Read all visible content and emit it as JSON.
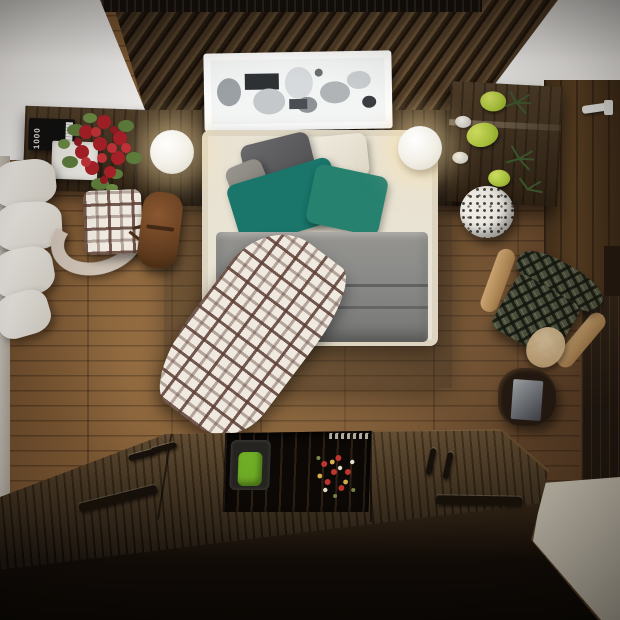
{
  "scene": {
    "description": "Top-down 3D render of a modern bedroom with dark wood accents",
    "book": {
      "spine_label": "1000"
    },
    "palette": {
      "floor_wood": "#7b5733",
      "ceiling_slats": "#473520",
      "white_ceiling": "#f4f3f1",
      "walnut_furniture": "#3c2c1a",
      "platform_deck": "#4a3723",
      "platform_front": "#0a0705",
      "bed_upholstery": "#e9e3d3",
      "duvet_gray": "#8c8c8a",
      "pillow_dark_gray": "#55555a",
      "pillow_teal_long": "#1a756a",
      "pillow_teal_square": "#27816f",
      "plaid_throw_brown": "#6b5a50",
      "tartan_chair_green": "#4d5340",
      "accent_chair_green": "#6fae26",
      "roses_red": "#b3242a",
      "pears_green": "#aec93c",
      "leather_pouf": "#6b3f22",
      "cream_floor_strip": "#d9d3c6",
      "wardrobe_dark": "#1f1710",
      "door_wood": "#5c4124"
    },
    "rug": {
      "cells": [
        "#dcdcda",
        "#e8e8e4",
        "#d3d3cf",
        "#c7c7c3",
        "#9aa0a6",
        "#e2e2de",
        "#c9c9c5",
        "#9fa3a7",
        "#e6e6e2",
        "#d8d8d4",
        "#e8e8e4",
        "#7d8186",
        "#8e9296",
        "#d8d8d4",
        "#c9c9c5",
        "#e4e4e0",
        "#d5d5d1",
        "#8e9296",
        "#d8d8d4",
        "#e4e4e0",
        "#9a9a96",
        "#6e7276",
        "#e0e0dc",
        "#d8d8d4"
      ]
    },
    "objects": [
      "wood-slat ceiling panel",
      "white sloped ceiling",
      "double bed with gray duvet",
      "teal and gray pillows",
      "brown-white plaid throw",
      "patchwork gray rug",
      "two white sphere lamps",
      "floating white display shelf",
      "walnut desk with red roses",
      "book stack",
      "white tray",
      "plaid armchair",
      "leather pouf",
      "white pillow stack",
      "walnut desk with green pears and plates",
      "speckled ceramic stool",
      "green tartan armchair",
      "dark object with mirror",
      "wardrobe",
      "wooden door with white handle",
      "storage platform with lids and handles",
      "recessed nook with green chair",
      "small flower bouquet",
      "cream floor strip"
    ]
  }
}
